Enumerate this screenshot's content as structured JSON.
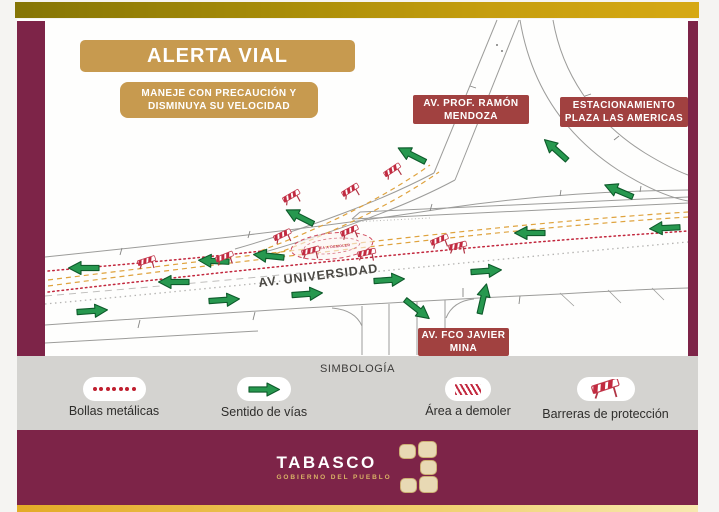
{
  "alert": {
    "title": "ALERTA VIAL",
    "subtitle_line1": "MANEJE CON PRECAUCIÓN Y",
    "subtitle_line2": "DISMINUYA SU VELOCIDAD"
  },
  "map": {
    "labels": [
      {
        "line1": "AV. PROF. RAMÓN",
        "line2": "MENDOZA"
      },
      {
        "line1": "ESTACIONAMIENTO",
        "line2": "PLAZA LAS AMERICAS"
      },
      {
        "line1": "AV. FCO JAVIER",
        "line2": "MINA"
      }
    ],
    "street_label": "AV. UNIVERSIDAD",
    "zone_label": "ÁREA A DEMOLER"
  },
  "legend": {
    "title": "SIMBOLOGÍA",
    "items": [
      {
        "label": "Bollas metálicas",
        "icon": "bollards-icon"
      },
      {
        "label": "Sentido de vías",
        "icon": "direction-arrow-icon"
      },
      {
        "label": "Área a demoler",
        "icon": "demolition-area-icon"
      },
      {
        "label": "Barreras de protección",
        "icon": "barrier-icon"
      }
    ]
  },
  "footer": {
    "brand": "TABASCO",
    "tagline": "GOBIERNO DEL PUEBLO"
  },
  "colors": {
    "frame_maroon": "#7d2448",
    "frame_gold": "#c69e0f",
    "banner_tan": "#c79a4f",
    "label_red": "#a14140",
    "arrow_green": "#27984f",
    "barrier_red": "#c22a40",
    "bollard_red": "#c01f2f",
    "guide_orange": "#dfa33e",
    "road_gray": "#9c9c9a",
    "legend_bg": "#d4d3d0"
  }
}
